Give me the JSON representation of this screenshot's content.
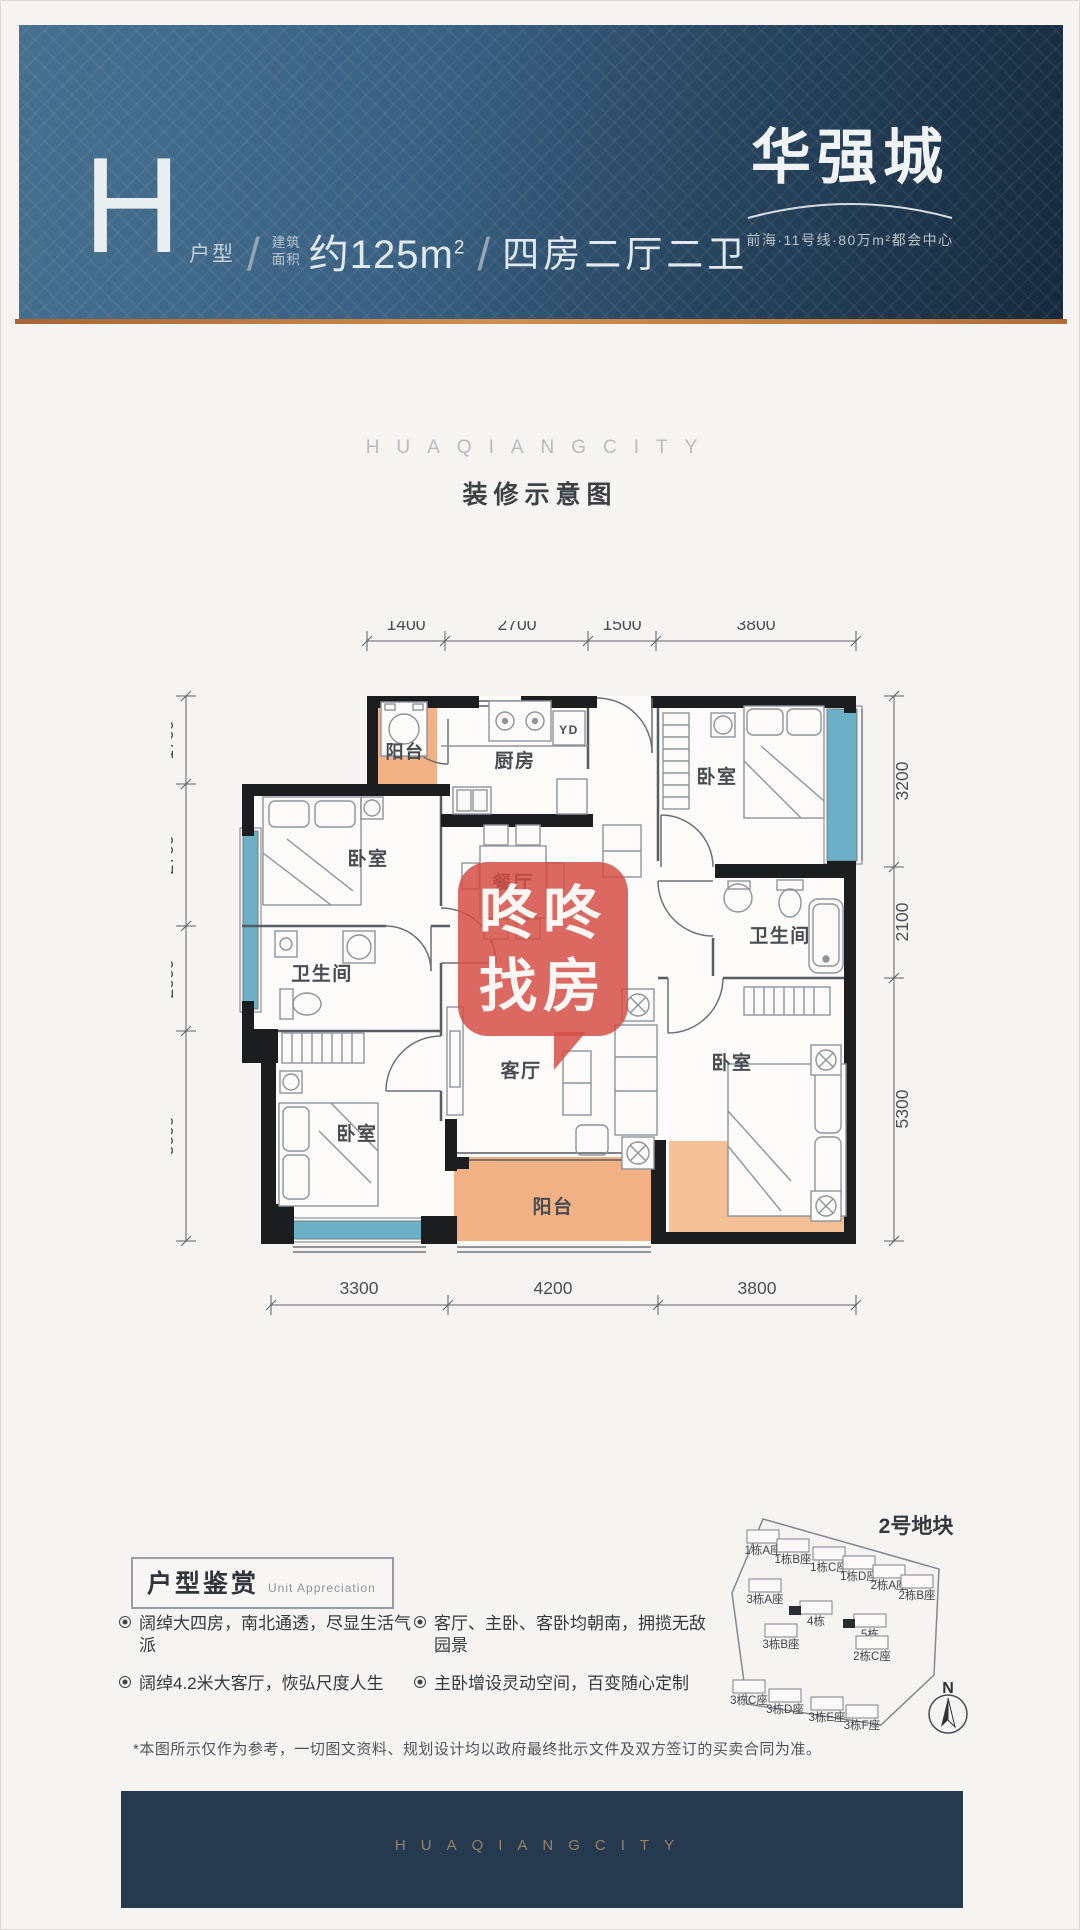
{
  "header": {
    "unit_letter": "H",
    "unit_type_label": "户型",
    "separator": "/",
    "area_label_l1": "建筑",
    "area_label_l2": "面积",
    "area_value": "约125m",
    "area_exponent": "2",
    "layout_text": "四房二厅二卫",
    "brand_name": "华强城",
    "brand_tagline": "前海·11号线·80万m²都会中心"
  },
  "section": {
    "watermark_en": "HUAQIANGCITY",
    "plan_caption": "装修示意图"
  },
  "floorplan": {
    "rooms": [
      {
        "label": "阳台",
        "x": 404,
        "y": 757,
        "size": 18
      },
      {
        "label": "厨房",
        "x": 514,
        "y": 766
      },
      {
        "label": "YD",
        "x": 568,
        "y": 733,
        "size": 12
      },
      {
        "label": "卧室",
        "x": 367,
        "y": 864
      },
      {
        "label": "餐厅",
        "x": 512,
        "y": 888
      },
      {
        "label": "卫生间",
        "x": 321,
        "y": 979
      },
      {
        "label": "卧室",
        "x": 356,
        "y": 1139
      },
      {
        "label": "客厅",
        "x": 520,
        "y": 1076
      },
      {
        "label": "阳台",
        "x": 552,
        "y": 1212
      },
      {
        "label": "卧室",
        "x": 716,
        "y": 782
      },
      {
        "label": "卫生间",
        "x": 779,
        "y": 941
      },
      {
        "label": "卧室",
        "x": 731,
        "y": 1068
      }
    ],
    "dims": [
      {
        "o": "h",
        "line": 640,
        "label_pos": 629,
        "ticks": [
          366,
          444,
          587,
          655,
          855
        ],
        "labels": [
          {
            "t": "1400",
            "c": 405
          },
          {
            "t": "2700",
            "c": 516
          },
          {
            "t": "1500",
            "c": 621
          },
          {
            "t": "3800",
            "c": 755
          }
        ]
      },
      {
        "o": "h",
        "line": 1304,
        "label_pos": 1293,
        "ticks": [
          270,
          447,
          657,
          855
        ],
        "labels": [
          {
            "t": "3300",
            "c": 358
          },
          {
            "t": "4200",
            "c": 552
          },
          {
            "t": "3800",
            "c": 756
          }
        ]
      },
      {
        "o": "v",
        "line": 185,
        "label_pos": 172,
        "ticks": [
          695,
          783,
          925,
          1030,
          1240
        ],
        "labels": [
          {
            "t": "1700",
            "c": 739
          },
          {
            "t": "2700",
            "c": 854
          },
          {
            "t": "2000",
            "c": 978
          },
          {
            "t": "3600",
            "c": 1135
          }
        ]
      },
      {
        "o": "v",
        "line": 893,
        "label_pos": 907,
        "ticks": [
          695,
          866,
          977,
          1240
        ],
        "labels": [
          {
            "t": "3200",
            "c": 780
          },
          {
            "t": "2100",
            "c": 921
          },
          {
            "t": "5300",
            "c": 1108
          }
        ]
      }
    ],
    "colors": {
      "wall": "#1c1d1f",
      "window": "#6cb0c7",
      "balcony": "#f2b184",
      "extension": "#f3c097",
      "watermark_red": "#d44c44"
    }
  },
  "watermark": {
    "line1": "咚咚",
    "line2": "找房"
  },
  "appreciation": {
    "title": "户型鉴赏",
    "subtitle": "Unit Appreciation",
    "bullets": [
      "阔绰大四房，南北通透，尽显生活气派",
      "客厅、主卧、客卧均朝南，拥揽无敌园景",
      "阔绰4.2米大客厅，恢弘尺度人生",
      "主卧增设灵动空间，百变随心定制"
    ]
  },
  "siteplan": {
    "title": "2号地块",
    "north_label": "N",
    "buildings": [
      {
        "label": "1栋A座",
        "x": 762,
        "y": 1553
      },
      {
        "label": "1栋B座",
        "x": 792,
        "y": 1562
      },
      {
        "label": "1栋C座",
        "x": 828,
        "y": 1570
      },
      {
        "label": "1栋D座",
        "x": 858,
        "y": 1579
      },
      {
        "label": "2栋A座",
        "x": 888,
        "y": 1588
      },
      {
        "label": "2栋B座",
        "x": 916,
        "y": 1598
      },
      {
        "label": "3栋A座",
        "x": 764,
        "y": 1602
      },
      {
        "label": "4栋",
        "x": 815,
        "y": 1624,
        "m": true
      },
      {
        "label": "5栋",
        "x": 869,
        "y": 1637,
        "m": true
      },
      {
        "label": "3栋B座",
        "x": 780,
        "y": 1647
      },
      {
        "label": "2栋C座",
        "x": 871,
        "y": 1659
      },
      {
        "label": "3栋C座",
        "x": 748,
        "y": 1703
      },
      {
        "label": "3栋D座",
        "x": 784,
        "y": 1712
      },
      {
        "label": "3栋E座",
        "x": 826,
        "y": 1720
      },
      {
        "label": "3栋F座",
        "x": 861,
        "y": 1728
      }
    ]
  },
  "disclaimer": "*本图所示仅作为参考，一切图文资料、规划设计均以政府最终批示文件及双方签订的买卖合同为准。",
  "footer": {
    "brand_en": "HUAQIANGCITY"
  }
}
